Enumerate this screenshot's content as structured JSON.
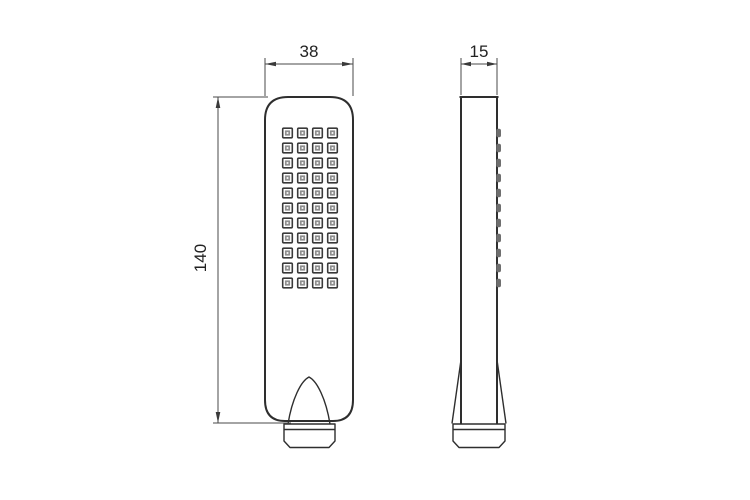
{
  "drawing": {
    "dimensions": {
      "front_width": "38",
      "height": "140",
      "side_depth": "15"
    },
    "nozzle_grid": {
      "rows": 11,
      "cols": 4
    },
    "colors": {
      "outline": "#2e2e2e",
      "dimension_line": "#4a4a4a",
      "nozzle_inner": "#8f8f8f",
      "side_bump": "#6e6e6e",
      "background": "#ffffff"
    }
  }
}
